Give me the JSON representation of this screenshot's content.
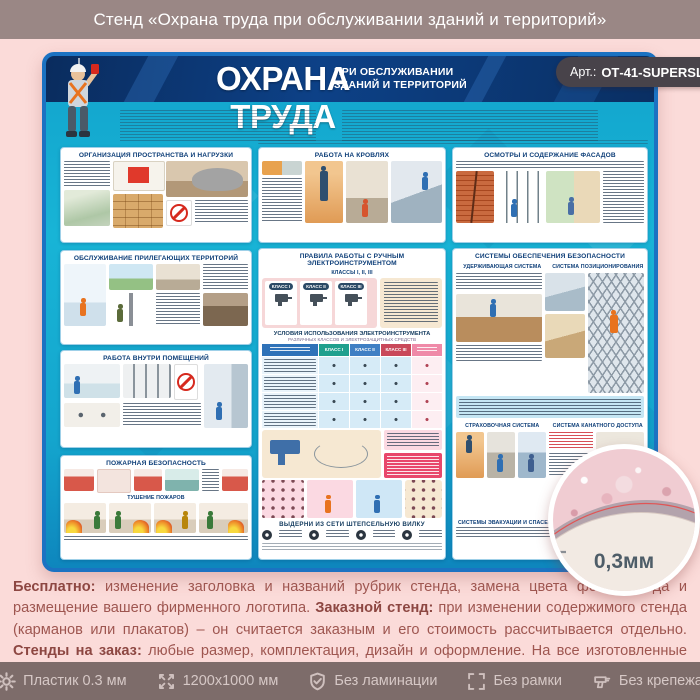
{
  "window": {
    "title": "Стенд «Охрана труда при обслуживании зданий и территорий»"
  },
  "badge": {
    "prefix": "Арт.:",
    "code": "ОТ-41-SUPERSLIM"
  },
  "poster": {
    "title": "ОХРАНА ТРУДА",
    "subtitle_line1": "ПРИ ОБСЛУЖИВАНИИ",
    "subtitle_line2": "ЗДАНИЙ И ТЕРРИТОРИЙ",
    "sections": {
      "organization": "ОРГАНИЗАЦИЯ ПРОСТРАНСТВА И НАГРУЗКИ",
      "territory": "ОБСЛУЖИВАНИЕ ПРИЛЕГАЮЩИХ ТЕРРИТОРИЙ",
      "indoor": "РАБОТА ВНУТРИ ПОМЕЩЕНИЙ",
      "fire": "ПОЖАРНАЯ БЕЗОПАСНОСТЬ",
      "fire_sub": "ТУШЕНИЕ ПОЖАРОВ",
      "roofs": "РАБОТА НА КРОВЛЯХ",
      "tools": "ПРАВИЛА РАБОТЫ С РУЧНЫМ ЭЛЕКТРОИНСТРУМЕНТОМ",
      "tools_sub": "КЛАССЫ I, II, III",
      "tools_class1": "КЛАСС I",
      "tools_class2": "КЛАСС II",
      "tools_class3": "КЛАСС III",
      "tools_table_title": "УСЛОВИЯ ИСПОЛЬЗОВАНИЯ ЭЛЕКТРОИНСТРУМЕНТА",
      "tools_table_sub": "РАЗЛИЧНЫХ КЛАССОВ И ЭЛЕКТРОЗАЩИТНЫХ СРЕДСТВ",
      "tools_plug": "ВЫДЕРНИ ИЗ СЕТИ ШТЕПСЕЛЬНУЮ ВИЛКУ",
      "facades": "ОСМОТРЫ И СОДЕРЖАНИЕ ФАСАДОВ",
      "safety": "СИСТЕМЫ ОБЕСПЕЧЕНИЯ БЕЗОПАСНОСТИ",
      "safety_sub1": "УДЕРЖИВАЮЩАЯ СИСТЕМА",
      "safety_sub2": "СИСТЕМА ПОЗИЦИОНИРОВАНИЯ",
      "safety_sub3": "СТРАХОВОЧНАЯ СИСТЕМА",
      "safety_sub4": "СИСТЕМА КАНАТНОГО ДОСТУПА",
      "safety_sub5": "СИСТЕМЫ ЭВАКУАЦИИ И СПАСЕНИЯ"
    }
  },
  "material_detail": {
    "thickness_label": "0,3мм"
  },
  "description": {
    "b1": "Бесплатно:",
    "t1": " изменение заголовка и названий рубрик стенда, замена цвета фона стенда и размещение вашего фирменного логотипа. ",
    "b2": "Заказной стенд:",
    "t2": " при изменении содержимого стенда (карманов или плакатов) – он считается заказным и его стоимость рассчитывается отдельно. ",
    "b3": "Стенды на заказ:",
    "t3": " любые размер, комплектация, дизайн и оформление. На все изготовленные стенды даем 2 года гарантии. Выгодно, эстетично и надежно!"
  },
  "footer": {
    "items": [
      {
        "icon": "gear-icon",
        "label": "Пластик 0.3 мм"
      },
      {
        "icon": "dimensions-icon",
        "label": "1200х1000 мм"
      },
      {
        "icon": "shield-check-icon",
        "label": "Без ламинации"
      },
      {
        "icon": "frame-icon",
        "label": "Без рамки"
      },
      {
        "icon": "drill-icon",
        "label": "Без крепежа"
      }
    ]
  },
  "colors": {
    "top_bar_bg": "#9a8785",
    "footer_bg": "#7d6c6a",
    "page_bg": "#fbdbd9",
    "poster_navy": "#0c3a70",
    "poster_cyan": "#16aed3",
    "poster_border": "#1b72c2",
    "badge_bg": "#48434a",
    "panel_title_color": "#0d3e78",
    "description_text": "#9e5650"
  }
}
